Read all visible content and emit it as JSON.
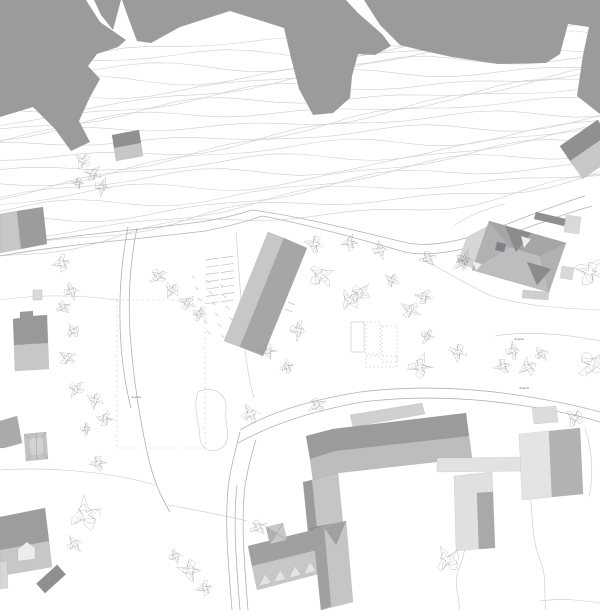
{
  "map": {
    "kind": "architectural-site-plan",
    "background_color": "#ffffff",
    "terrain_mass_color": "#9b9b9b",
    "contour_color": "#cecece",
    "road_color": "#b2b2b2",
    "outline_color": "#c9c9c9",
    "tree_color": "#8a8a8a",
    "building_colors": {
      "dark": "#8f9092",
      "medium": "#a5a6a8",
      "light": "#c6c7c9",
      "pale": "#e2e2e3",
      "white": "#ededee"
    },
    "annotations": [
      {
        "text": "illegible",
        "x": 131,
        "y": 398
      },
      {
        "text": "illegible",
        "x": 514,
        "y": 340
      },
      {
        "text": "illegible",
        "x": 519,
        "y": 389
      }
    ]
  }
}
